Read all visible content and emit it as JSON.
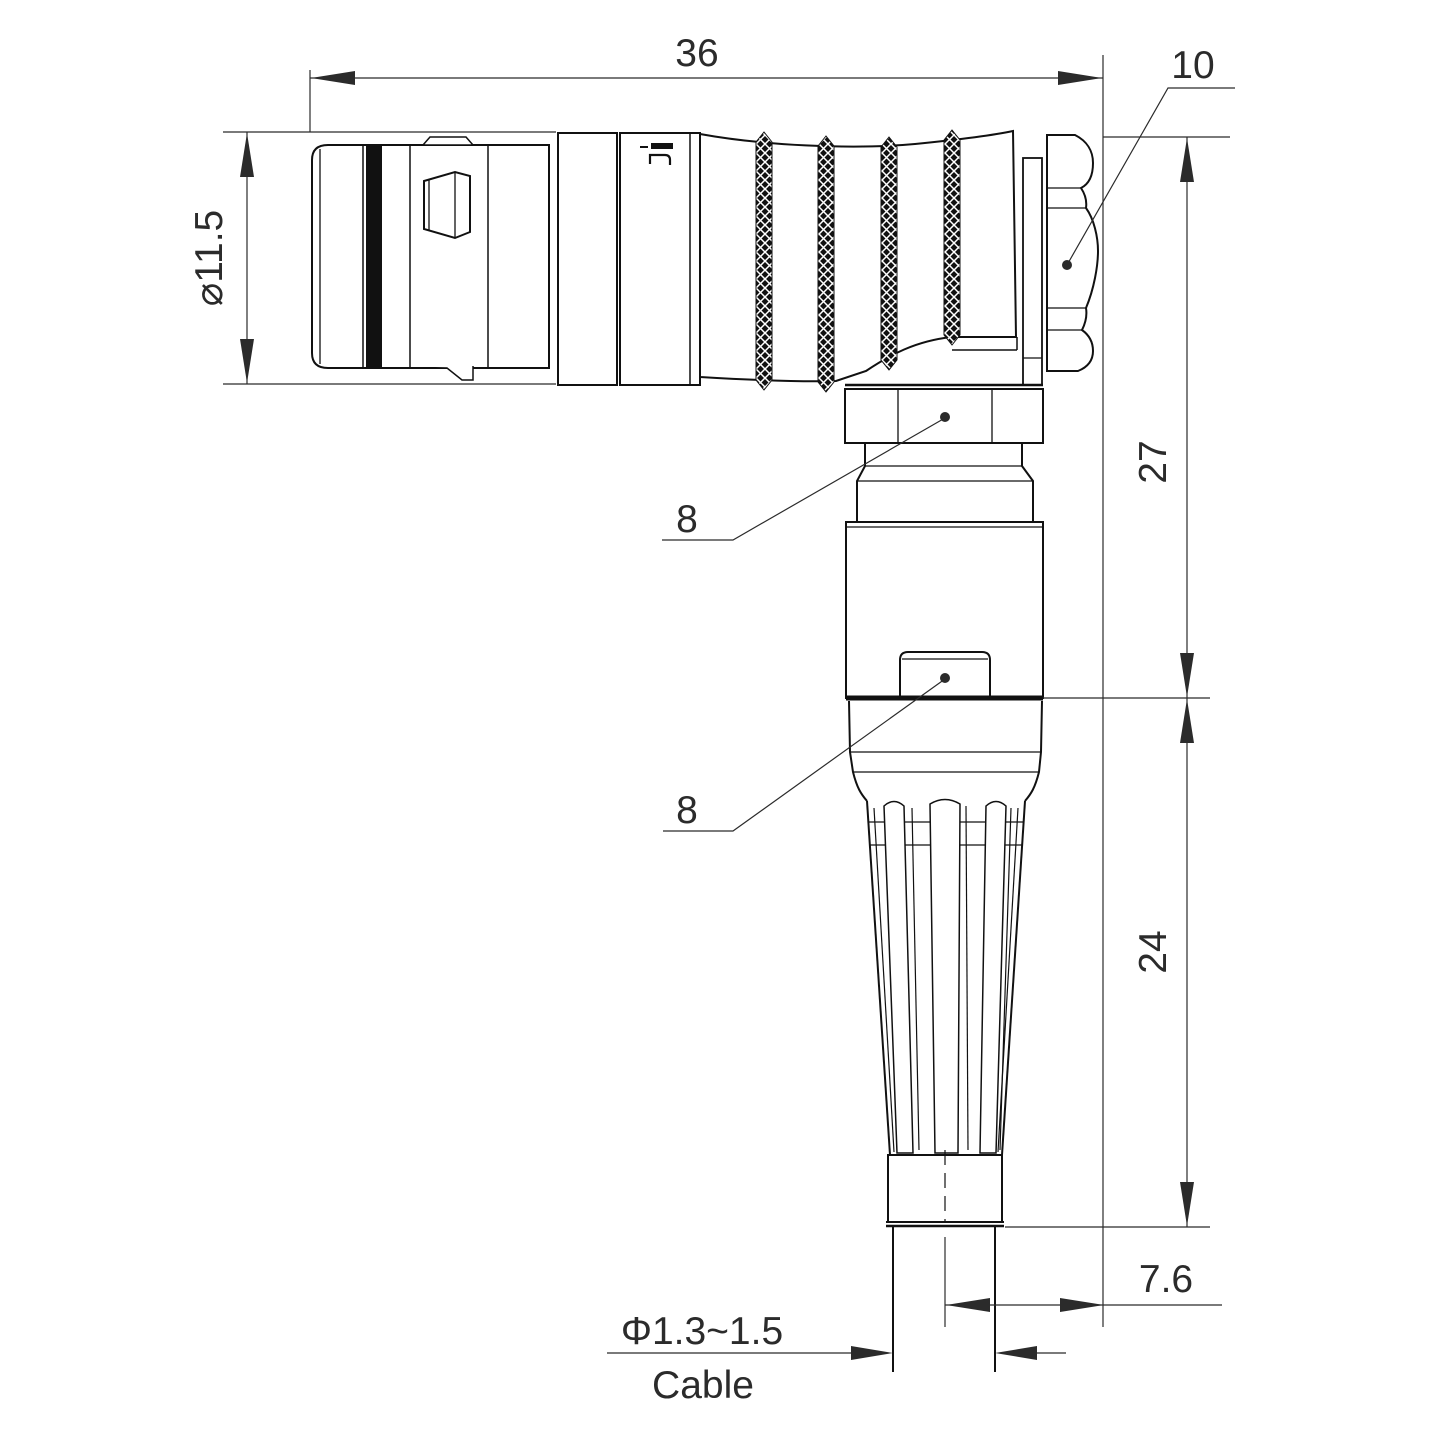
{
  "drawing": {
    "watermark": "Lightany",
    "dims": {
      "overall_length": "36",
      "nut_across_flats": "10",
      "shell_diameter": "⌀11.5",
      "upper_height": "27",
      "lower_height": "24",
      "cable_offset": "7.6",
      "cable_diameter": "Φ1.3~1.5",
      "cable_label": "Cable"
    },
    "callouts": {
      "coupling_nut": "8",
      "latch": "8"
    },
    "colors": {
      "line": "#111111",
      "dimension": "#2b2b2b",
      "watermark_pink": "#dd8f8f",
      "background": "#ffffff"
    }
  }
}
